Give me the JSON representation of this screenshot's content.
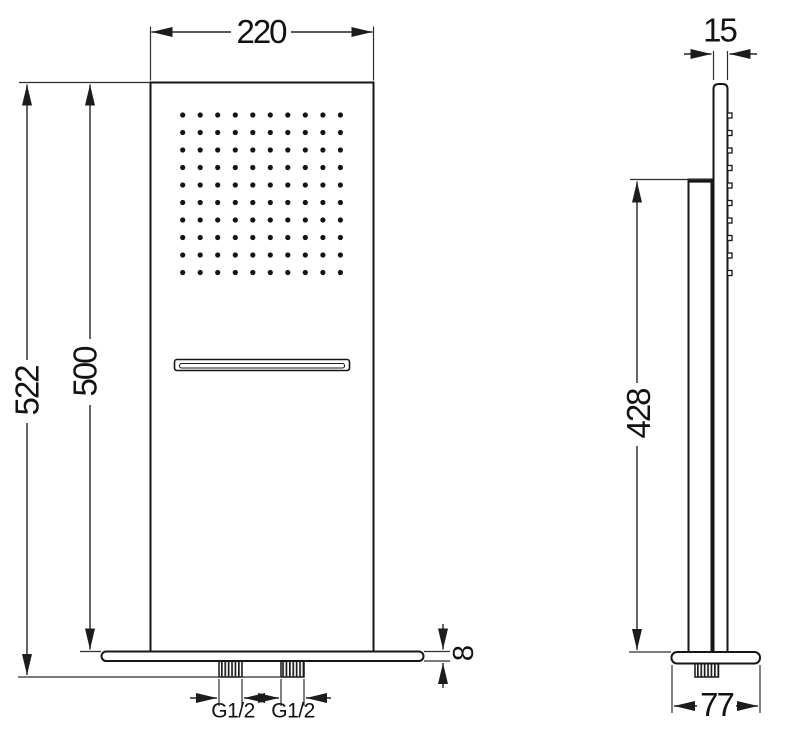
{
  "front_view": {
    "width_label": "220",
    "overall_height_label": "522",
    "panel_height_label": "500",
    "base_thickness_label": "8",
    "left_thread_label": "G1/2",
    "right_thread_label": "G1/2"
  },
  "side_view": {
    "thickness_label": "15",
    "mount_height_label": "428",
    "base_depth_label": "77"
  },
  "spray_grid": {
    "rows": 10,
    "cols": 10,
    "x0": 182.7,
    "y0": 115,
    "dx": 17.52,
    "dy": 17.5,
    "dot_r": 2.6,
    "color": "#141414"
  },
  "side_nozzles": {
    "count": 10,
    "x": 727.5,
    "y0": 115.5,
    "dy": 17.5,
    "w": 4.5,
    "h": 5
  },
  "colors": {
    "outline": "#161616",
    "dimension": "#242424",
    "text": "#121212",
    "background": "#ffffff"
  }
}
